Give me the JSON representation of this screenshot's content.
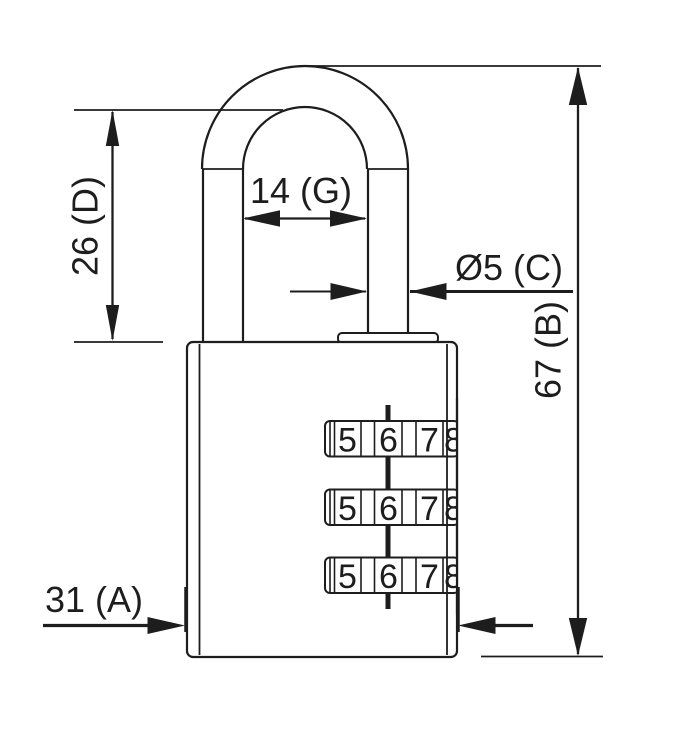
{
  "drawing": {
    "type": "technical-dimension-drawing",
    "subject": "combination padlock front view",
    "colors": {
      "line": "#1d1d1d",
      "background": "#ffffff"
    },
    "labels": {
      "shackle_clearance_height": "26 (D)",
      "shackle_inner_width": "14 (G)",
      "shackle_diameter": "Ø5 (C)",
      "overall_height": "67 (B)",
      "body_width": "31 (A)"
    },
    "dials": {
      "rows": 3,
      "digits": [
        "5",
        "6",
        "7",
        "8"
      ]
    }
  }
}
